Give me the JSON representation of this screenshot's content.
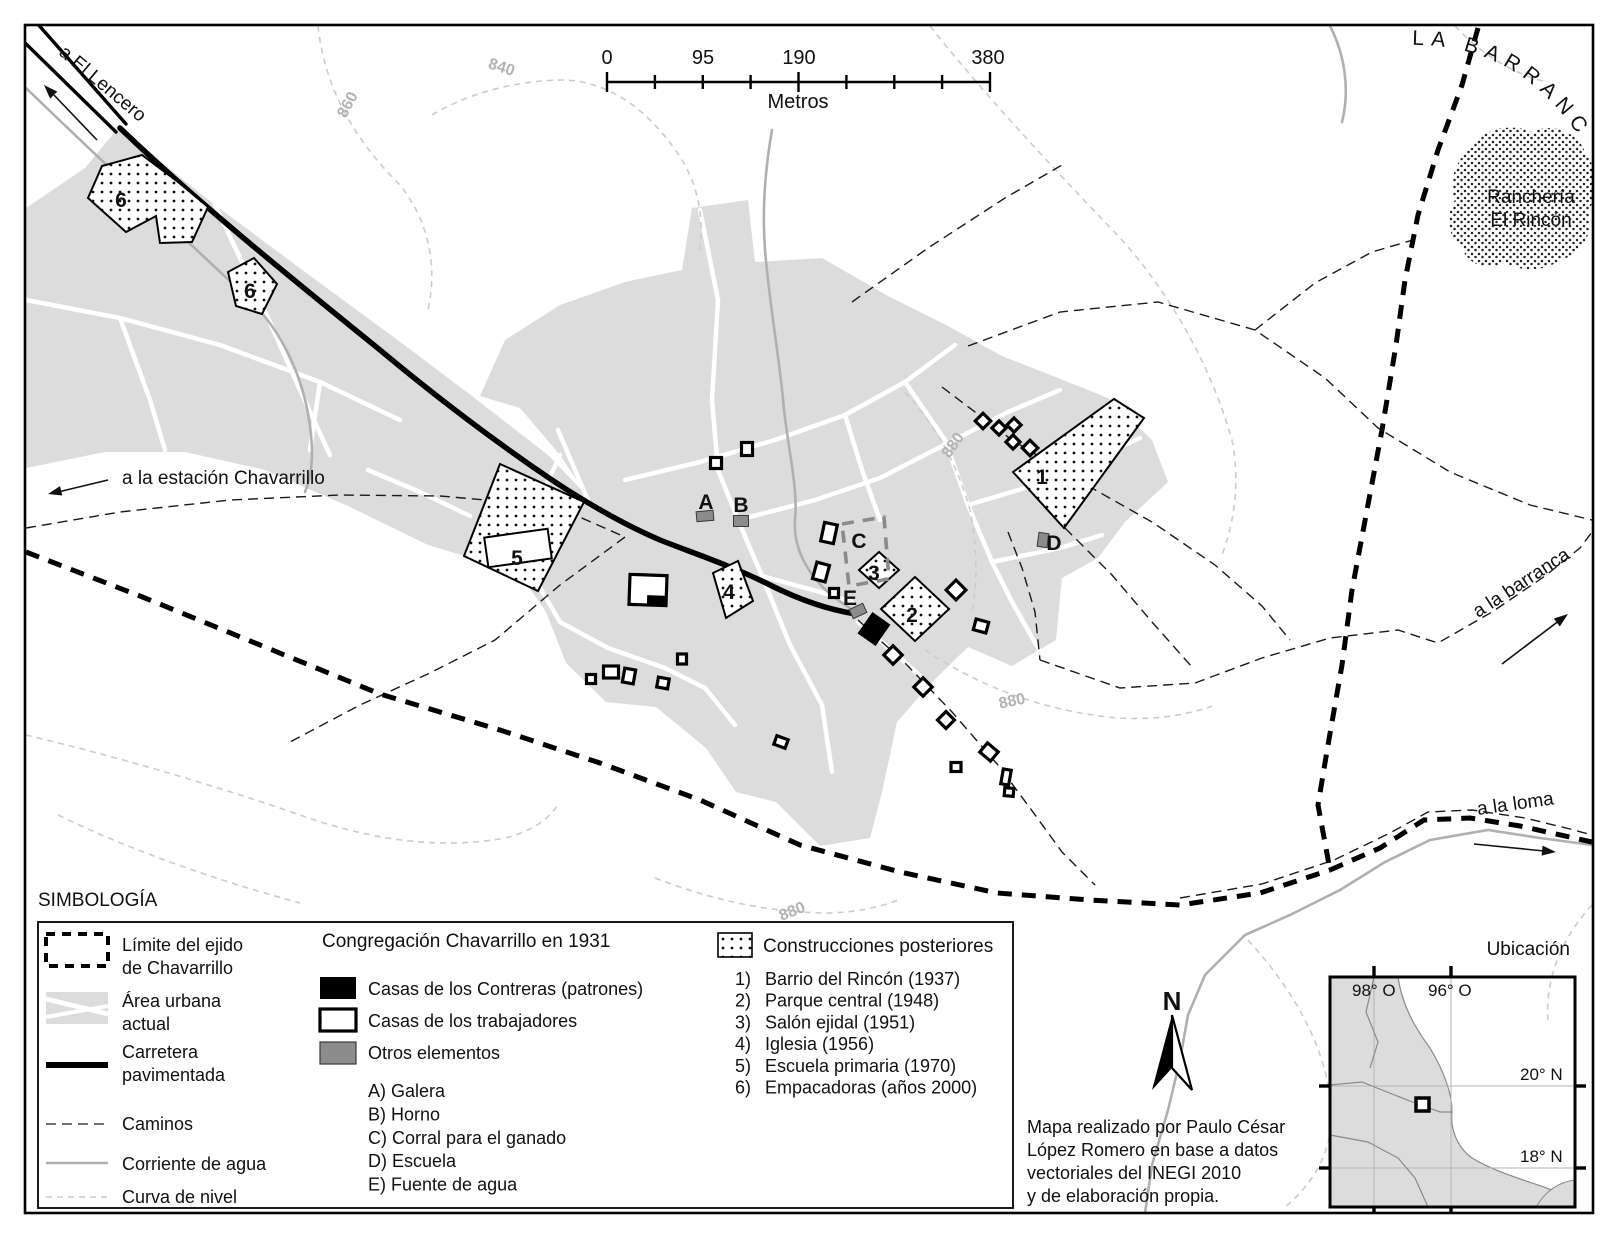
{
  "colors": {
    "urban_area": "#dcdcdc",
    "gray_element": "#8c8c8c",
    "water": "#b0b0b0",
    "contour": "#cccccc",
    "ink": "#000000"
  },
  "scale_bar": {
    "unit": "Metros",
    "labels": [
      {
        "t": "0",
        "x": 607,
        "y": 64
      },
      {
        "t": "95",
        "x": 703,
        "y": 64
      },
      {
        "t": "190",
        "x": 799,
        "y": 64
      },
      {
        "t": "380",
        "x": 988,
        "y": 64
      }
    ]
  },
  "direction_labels": {
    "el_lencero": "a El Lencero",
    "estacion": "a la estación Chavarrillo",
    "barranca_top": "LA BARRANCA",
    "barranca_right": "a la barranca",
    "loma": "a la loma"
  },
  "rancheria": {
    "line1": "Ranchería",
    "line2": "El Rincón"
  },
  "contour_labels": [
    {
      "t": "860",
      "x": 352,
      "y": 107,
      "r": -62
    },
    {
      "t": "840",
      "x": 500,
      "y": 72,
      "r": 18
    },
    {
      "t": "880",
      "x": 957,
      "y": 448,
      "r": -55
    },
    {
      "t": "880",
      "x": 1013,
      "y": 706,
      "r": -12
    },
    {
      "t": "880",
      "x": 794,
      "y": 916,
      "r": -22
    }
  ],
  "map_markers": {
    "numbers": [
      {
        "t": "6",
        "x": 121,
        "y": 207
      },
      {
        "t": "6",
        "x": 250,
        "y": 298
      },
      {
        "t": "5",
        "x": 517,
        "y": 565
      },
      {
        "t": "4",
        "x": 729,
        "y": 599
      },
      {
        "t": "3",
        "x": 874,
        "y": 580
      },
      {
        "t": "2",
        "x": 912,
        "y": 622
      },
      {
        "t": "1",
        "x": 1042,
        "y": 484
      }
    ],
    "letters": [
      {
        "t": "A",
        "x": 706,
        "y": 509
      },
      {
        "t": "B",
        "x": 741,
        "y": 512
      },
      {
        "t": "C",
        "x": 859,
        "y": 548
      },
      {
        "t": "D",
        "x": 1054,
        "y": 550
      },
      {
        "t": "E",
        "x": 850,
        "y": 605
      }
    ]
  },
  "legend": {
    "title": "SIMBOLOGÍA",
    "simbologia": {
      "limite1": "Límite del ejido",
      "limite2": "de Chavarrillo",
      "area1": "Área urbana",
      "area2": "actual",
      "carretera1": "Carretera",
      "carretera2": "pavimentada",
      "caminos": "Caminos",
      "corriente": "Corriente de agua",
      "curva": "Curva de nivel"
    },
    "congregacion": {
      "title": "Congregación Chavarrillo en 1931",
      "contreras": "Casas de los Contreras (patrones)",
      "trabajadores": "Casas de los trabajadores",
      "otros": "Otros elementos",
      "sublist": [
        "A) Galera",
        "B) Horno",
        "C) Corral para el ganado",
        "D) Escuela",
        "E) Fuente de agua"
      ]
    },
    "posteriores": {
      "title": "Construcciones posteriores",
      "items": [
        {
          "n": "1)",
          "label": "Barrio del Rincón (1937)"
        },
        {
          "n": "2)",
          "label": "Parque central (1948)"
        },
        {
          "n": "3)",
          "label": "Salón ejidal (1951)"
        },
        {
          "n": "4)",
          "label": "Iglesia (1956)"
        },
        {
          "n": "5)",
          "label": "Escuela primaria (1970)"
        },
        {
          "n": "6)",
          "label": "Empacadoras (años 2000)"
        }
      ]
    }
  },
  "north_label": "N",
  "inset": {
    "title": "Ubicación",
    "lon": [
      "98° O",
      "96° O"
    ],
    "lat": [
      "20° N",
      "18° N"
    ]
  },
  "attribution": {
    "lines": [
      "Mapa realizado por Paulo César",
      "López Romero en base a datos",
      "vectoriales del INEGI 2010",
      "y de elaboración propia."
    ]
  }
}
